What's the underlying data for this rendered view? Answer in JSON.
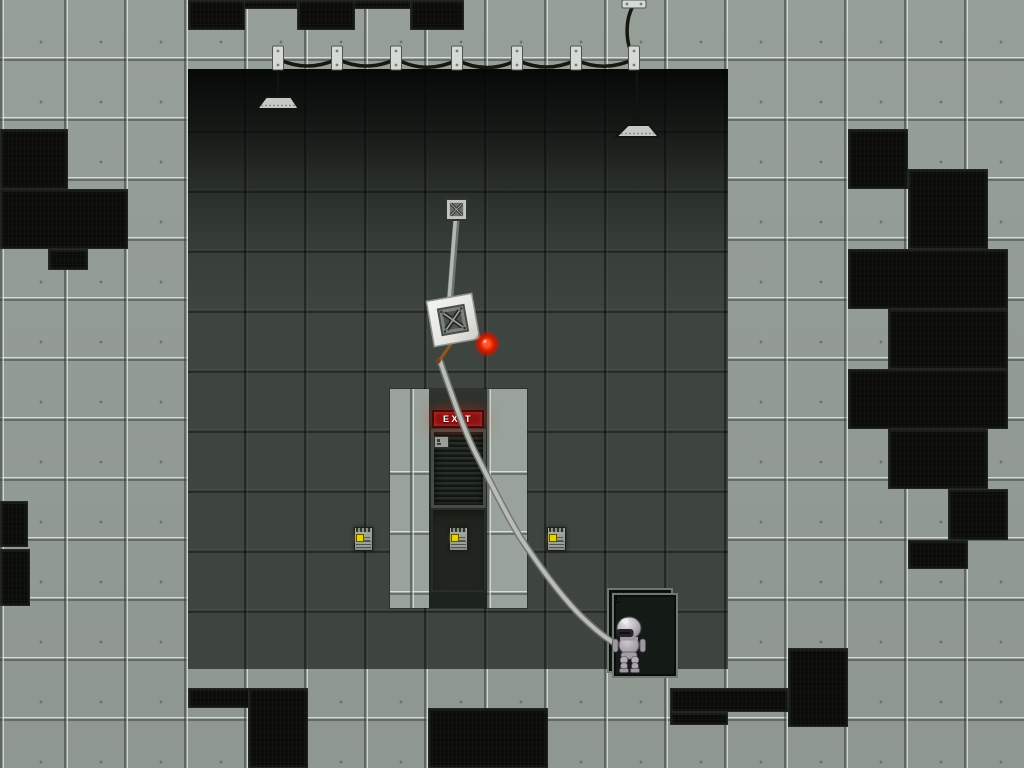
{
  "exit_sign": {
    "label": "EXIT"
  },
  "colors": {
    "tile-light": "#99a29b",
    "room-dark": "#3e4540",
    "black-tile": "#0b0c0a",
    "exit-red": "#8c1212",
    "exit-border": "#450c0c",
    "led-yellow": "#e6d200",
    "orb-red": "#f43300",
    "rope-gray": "#b9bcb7",
    "cable-black": "#16170f",
    "robot-gray": "#b2acb6"
  },
  "objects": {
    "black_tiles": [
      [
        188,
        0,
        276,
        9
      ],
      [
        188,
        0,
        57,
        30
      ],
      [
        297,
        0,
        58,
        30
      ],
      [
        410,
        0,
        54,
        30
      ],
      [
        0,
        129,
        68,
        60
      ],
      [
        0,
        189,
        128,
        60
      ],
      [
        48,
        249,
        40,
        21
      ],
      [
        0,
        501,
        28,
        46
      ],
      [
        0,
        549,
        30,
        57
      ],
      [
        848,
        129,
        60,
        60
      ],
      [
        908,
        169,
        80,
        80
      ],
      [
        848,
        249,
        160,
        60
      ],
      [
        888,
        309,
        120,
        60
      ],
      [
        848,
        369,
        160,
        60
      ],
      [
        888,
        429,
        100,
        60
      ],
      [
        948,
        489,
        60,
        51
      ],
      [
        908,
        540,
        60,
        29
      ],
      [
        188,
        688,
        120,
        20
      ],
      [
        248,
        688,
        60,
        80
      ],
      [
        428,
        708,
        120,
        60
      ],
      [
        788,
        648,
        60,
        79
      ],
      [
        670,
        688,
        118,
        24
      ],
      [
        670,
        712,
        58,
        13
      ]
    ],
    "chips": [
      [
        354,
        527
      ],
      [
        449,
        527
      ],
      [
        547,
        527
      ]
    ]
  }
}
